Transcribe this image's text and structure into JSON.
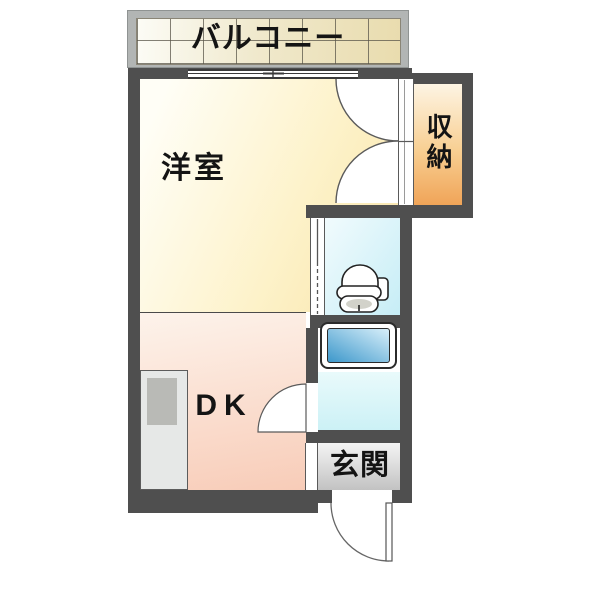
{
  "floorplan": {
    "balcony": {
      "label": "バルコニー"
    },
    "western_room": {
      "label": "洋室"
    },
    "storage": {
      "label": "収納"
    },
    "dining_kitchen": {
      "label": "DK"
    },
    "entrance": {
      "label": "玄関"
    },
    "icons": {
      "toilet": "toilet-icon",
      "bathtub": "bathtub-icon",
      "kitchen_counter": "kitchen-counter-icon",
      "sliding_window": "sliding-window-icon",
      "closet_doors": "double-door-swing-icon",
      "bath_door": "door-swing-icon",
      "entrance_door": "door-swing-icon",
      "toilet_door": "folding-door-icon"
    },
    "colors": {
      "wall": "#4f4f4f",
      "line": "#5a5a5a",
      "text": "#141414",
      "balcony_frame": "#b2b5b4",
      "tile_light": "#fcfcf6",
      "tile_dark": "#e9dcae",
      "room_light": "#fffef6",
      "room_dark": "#f8e3a8",
      "storage_light": "#fdf4e3",
      "storage_dark": "#f0a458",
      "dk_light": "#fdf3eb",
      "dk_dark": "#f8ccb8",
      "toilet_light": "#f1fbfd",
      "toilet_dark": "#c6edf6",
      "bathfloor_light": "#e9fafb",
      "bathfloor_dark": "#ccf1f6",
      "tub_light": "#d8effa",
      "tub_dark": "#3d98cb",
      "genkan_light": "#f4f4f4",
      "genkan_dark": "#c2c2c2"
    }
  }
}
